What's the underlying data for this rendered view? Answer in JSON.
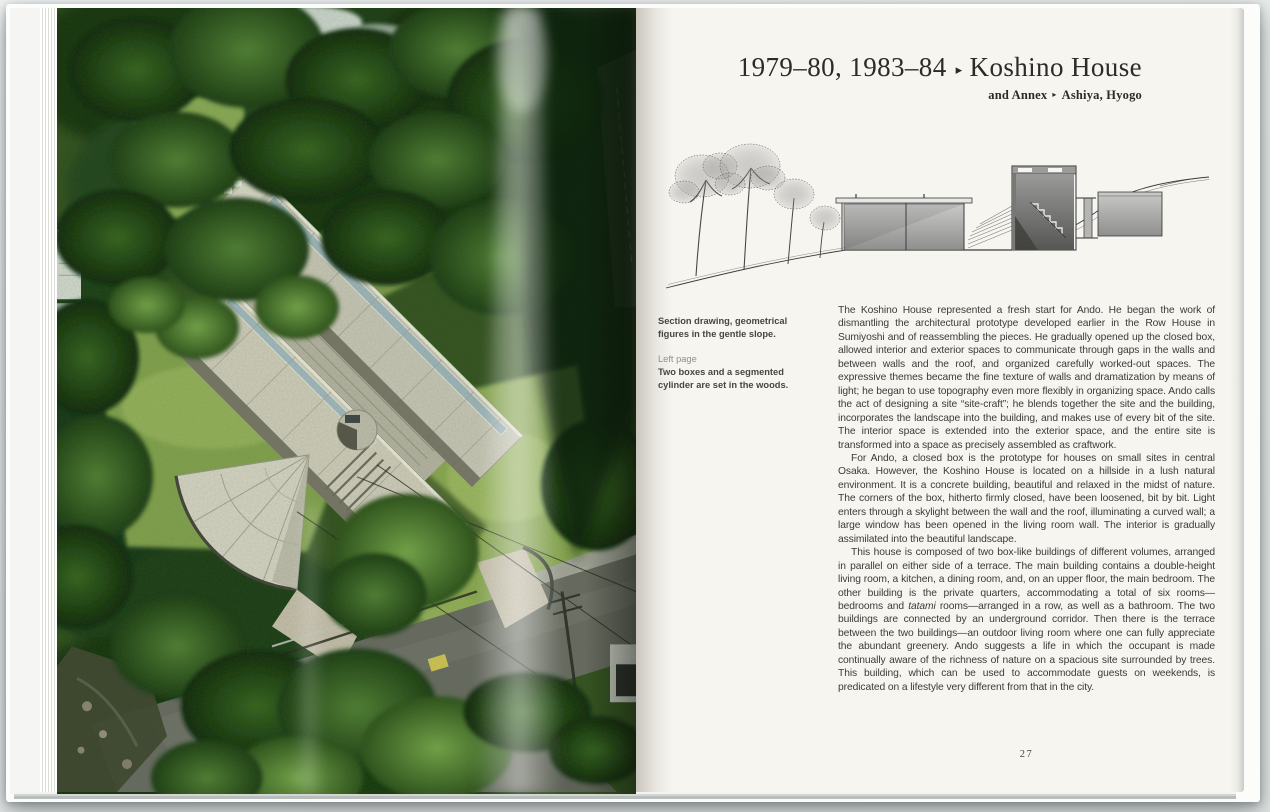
{
  "palette": {
    "backdrop": "#e7eaea",
    "paper": "#f7f5f0",
    "title_color": "#2c2b29",
    "body_color": "#3b3b3b",
    "caption_color": "#47463f",
    "caption_label_color": "#93908a",
    "forest_green": "#1d3a12",
    "grass_green": "#8aa651",
    "concrete": "#cbc7b9"
  },
  "header": {
    "years": "1979–80, 1983–84",
    "separator": "▸",
    "title": "Koshino House",
    "subtitle_prefix": "and Annex",
    "subtitle_separator": "▸",
    "subtitle_location": "Ashiya, Hyogo"
  },
  "captions": {
    "section_drawing": [
      "Section drawing, geometrical",
      "figures in the gentle slope."
    ],
    "left_page_label": "Left page",
    "left_page": [
      "Two boxes and a segmented",
      "cylinder are set in the woods."
    ]
  },
  "body": {
    "paragraphs": [
      [
        {
          "text": "The Koshino House represented a fresh start for Ando. He began the work of dismantling the architectural prototype developed earlier in the Row House in Sumiyoshi and of reassembling the pieces. He gradually opened up the closed box, allowed interior and exterior spaces to communicate through gaps in the walls and between walls and the roof, and organized carefully worked-out spaces. The expressive themes became the fine texture of walls and dramatization by means of light; he began to use topography even more flexibly in organizing space. Ando calls the act of designing a site “site-craft”; he blends together the site and the building, incorporates the landscape into the building, and makes use of every bit of the site. The interior space is extended into the exterior space, and the entire site is transformed into a space as precisely assembled as craftwork."
        }
      ],
      [
        {
          "text": "For Ando, a closed box is the prototype for houses on small sites in central Osaka. However, the Koshino House is located on a hillside in a lush natural environment. It is a concrete building, beautiful and relaxed in the midst of nature. The corners of the box, hitherto firmly closed, have been loosened, bit by bit. Light enters through a skylight between the wall and the roof, illuminating a curved wall; a large window has been opened in the living room wall. The interior is gradually assimilated into the beautiful landscape."
        }
      ],
      [
        {
          "text": "This house is composed of two box-like buildings of different volumes, arranged in parallel on either side of a terrace. The main building contains a double-height living room, a kitchen, a dining room, and, on an upper floor, the main bedroom. The other building is the private quarters, accommodating a total of six rooms—bedrooms and "
        },
        {
          "text": "tatami",
          "italic": true
        },
        {
          "text": " rooms—arranged in a row, as well as a bathroom. The two buildings are connected by an underground corridor. Then there is the terrace between the two buildings—an outdoor living room where one can fully appreciate the abundant greenery. Ando suggests a life in which the occupant is made continually aware of the richness of nature on a spacious site surrounded by trees. This building, which can be used to accommodate guests on weekends, is predicated on a lifestyle very different from that in the city."
        }
      ]
    ]
  },
  "footer": {
    "page_number": "27"
  }
}
